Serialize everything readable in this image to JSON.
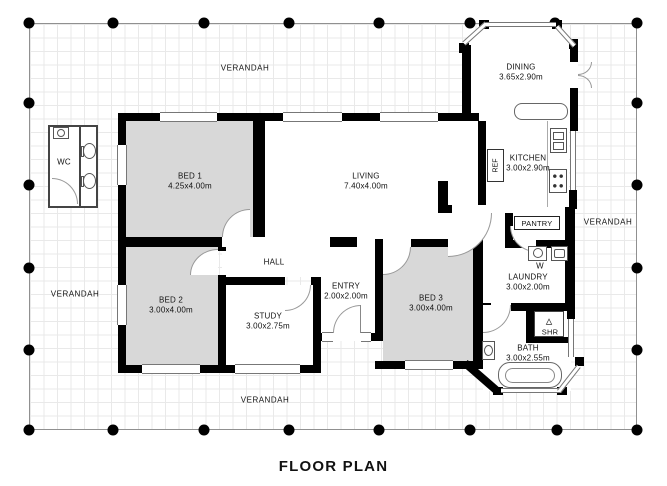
{
  "title": "FLOOR PLAN",
  "verandah": {
    "top": "VERANDAH",
    "left": "VERANDAH",
    "right": "VERANDAH",
    "bottom": "VERANDAH"
  },
  "rooms": [
    {
      "id": "bed1",
      "name": "BED 1",
      "dims": "4.25x4.00m"
    },
    {
      "id": "living",
      "name": "LIVING",
      "dims": "7.40x4.00m"
    },
    {
      "id": "dining",
      "name": "DINING",
      "dims": "3.65x2.90m"
    },
    {
      "id": "kitchen",
      "name": "KITCHEN",
      "dims": "3.00x2.90m"
    },
    {
      "id": "bed2",
      "name": "BED 2",
      "dims": "3.00x4.00m"
    },
    {
      "id": "study",
      "name": "STUDY",
      "dims": "3.00x2.75m"
    },
    {
      "id": "hall",
      "name": "HALL",
      "dims": ""
    },
    {
      "id": "entry",
      "name": "ENTRY",
      "dims": "2.00x2.00m"
    },
    {
      "id": "bed3",
      "name": "BED 3",
      "dims": "3.00x4.00m"
    },
    {
      "id": "laundry",
      "name": "LAUNDRY",
      "dims": "3.00x2.00m"
    },
    {
      "id": "bath",
      "name": "BATH",
      "dims": "3.00x2.55m"
    }
  ],
  "fixtures": {
    "wc": "WC",
    "pantry": "PANTRY",
    "shower": "SHR",
    "washer": "W",
    "fridge": "REF"
  },
  "colors": {
    "wall": "#000000",
    "bedroom_fill": "#d8d8d8",
    "grid_line": "#e9e9e9",
    "outline": "#909090",
    "drawing_line": "#555555"
  }
}
